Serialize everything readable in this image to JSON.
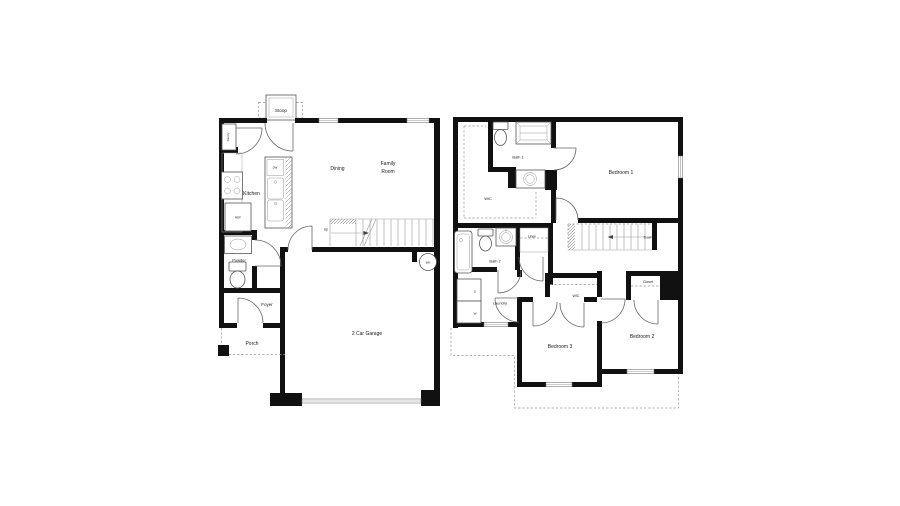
{
  "colors": {
    "wall": "#111111",
    "fixture_line": "#555555",
    "dashed_line": "#9a9a9a",
    "label_text": "#1a1a1a",
    "background": "#ffffff"
  },
  "floor1": {
    "labels": {
      "stoop": "Stoop",
      "pantry": "Pantry",
      "kitchen": "Kitchen",
      "dining": "Dining",
      "family_line1": "Family",
      "family_line2": "Room",
      "dw": "DW",
      "ref": "REF",
      "up": "Up",
      "powder": "Powder",
      "foyer": "Foyer",
      "porch": "Porch",
      "garage": "2 Car Garage",
      "wh": "WH"
    }
  },
  "floor2": {
    "labels": {
      "bath1": "Bath 1",
      "wic": "WIC",
      "bedroom1": "Bedroom 1",
      "down": "Down",
      "linen": "Linen",
      "bath2": "Bath 2",
      "laundry": "Laundry",
      "dryer": "D",
      "washer": "W",
      "wic_bed3": "WIC",
      "closet": "Closet",
      "bedroom3": "Bedroom 3",
      "bedroom2": "Bedroom 2"
    }
  }
}
